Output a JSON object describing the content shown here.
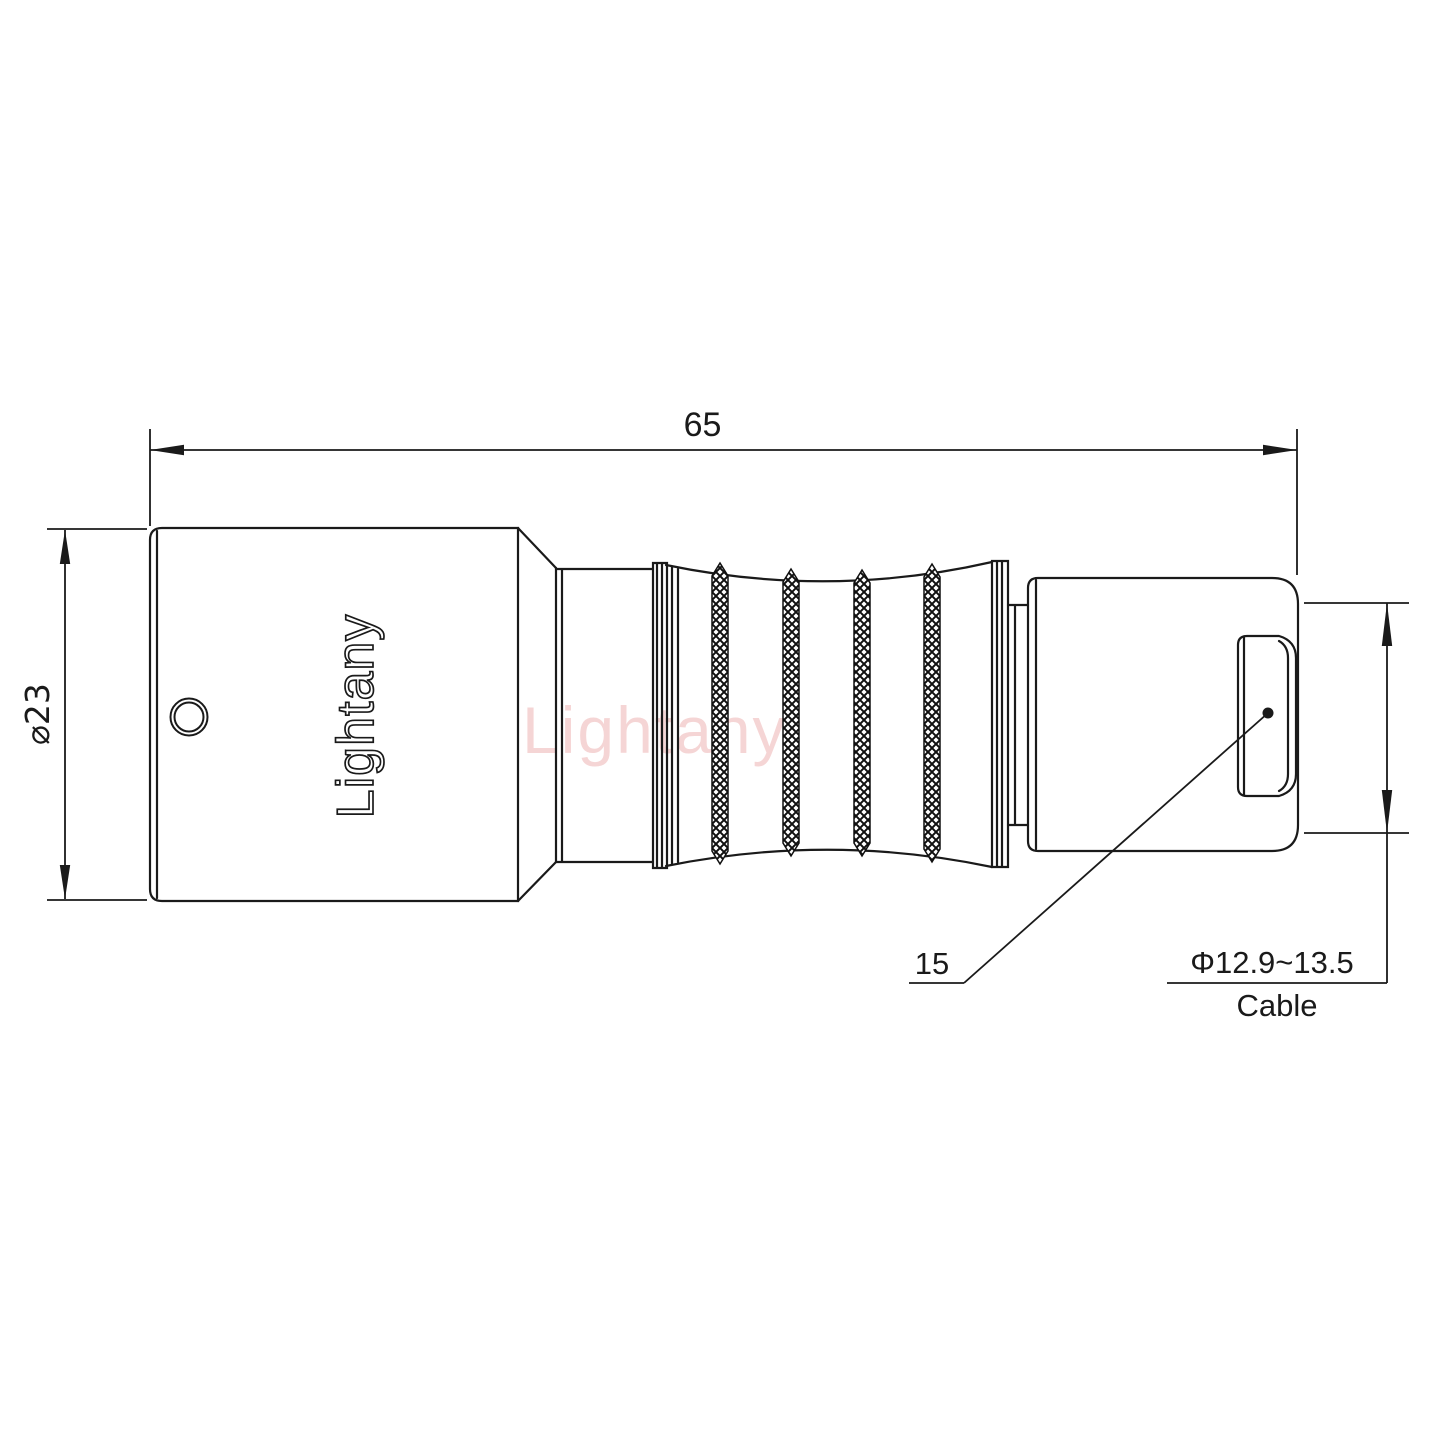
{
  "page": {
    "background": "#ffffff"
  },
  "drawing": {
    "line_color": "#1a1a1a",
    "watermark": {
      "text": "Lightany",
      "color": "#f0bcbc"
    },
    "connector": {
      "embossed_logo": "Lightany"
    },
    "dimensions": {
      "overall_length": {
        "label": "65"
      },
      "body_diameter": {
        "label": "⌀23"
      },
      "rear_callout": {
        "label": "15"
      },
      "cable_diameter": {
        "label": "Φ12.9~13.5",
        "caption": "Cable"
      }
    }
  }
}
